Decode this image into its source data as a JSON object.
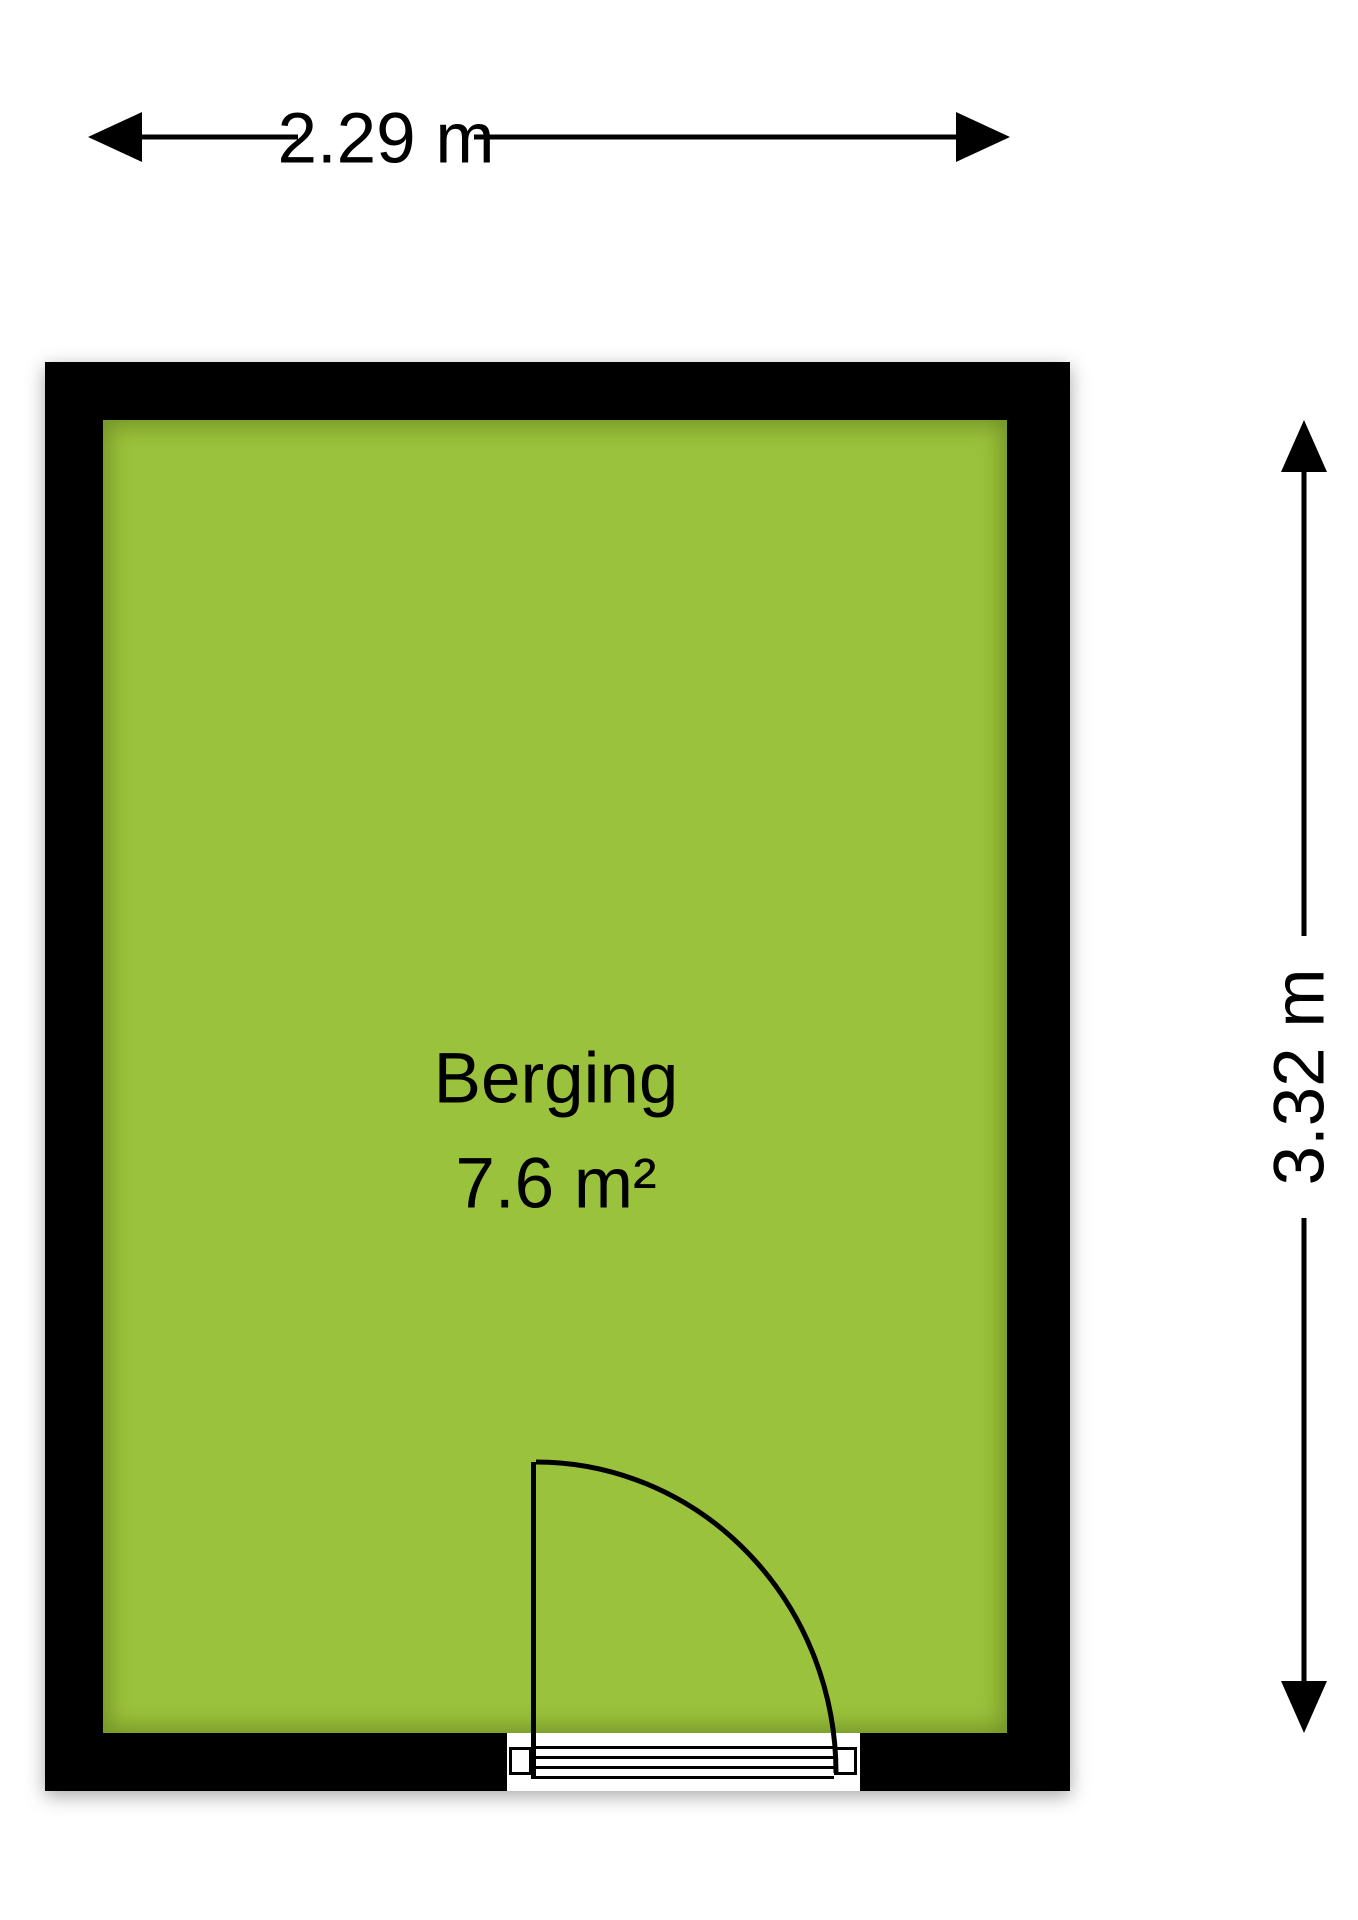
{
  "floorplan": {
    "dimensions": {
      "width_label": "2.29 m",
      "height_label": "3.32 m"
    },
    "room": {
      "name": "Berging",
      "area_label": "7.6 m²"
    },
    "colors": {
      "floor_fill": "#9BC23C",
      "wall": "#000000",
      "line": "#000000",
      "background": "#FFFFFF"
    }
  }
}
